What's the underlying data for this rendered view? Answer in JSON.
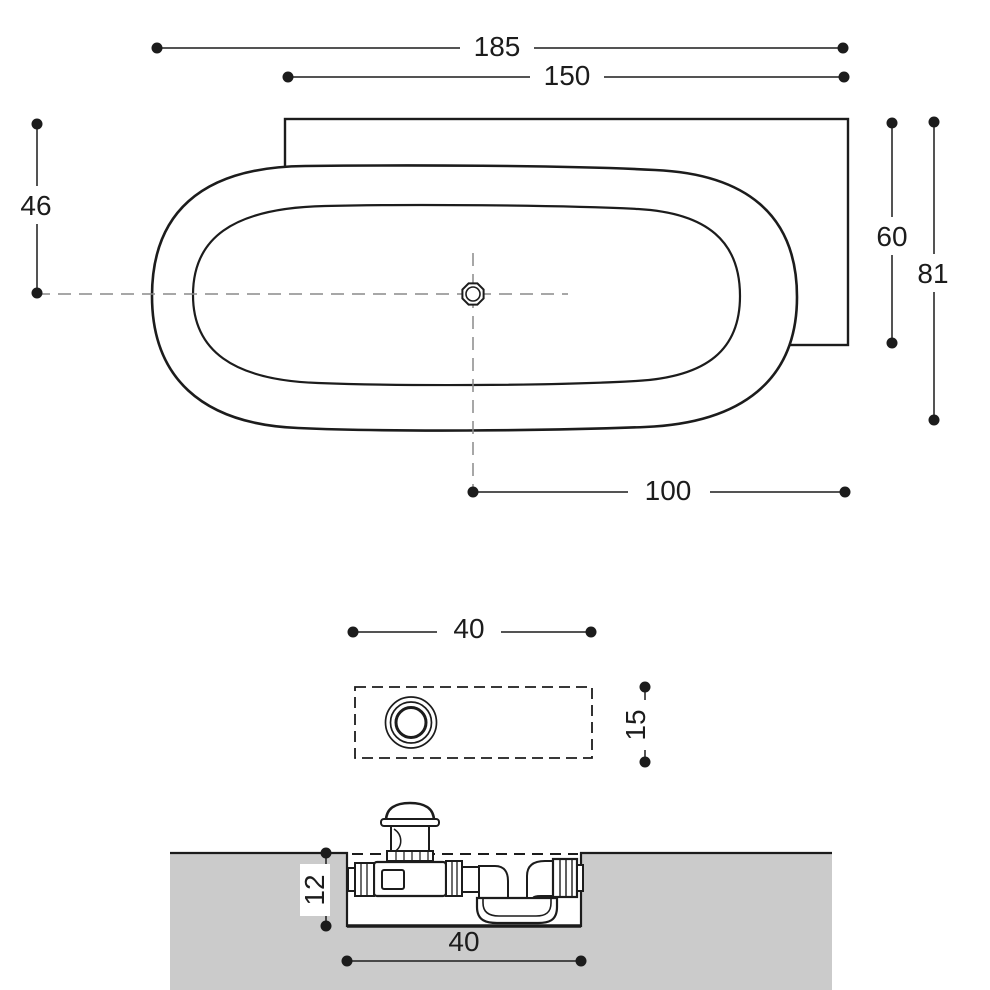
{
  "sheet": {
    "background": "#ffffff",
    "line_color": "#1c1c1c",
    "centerline_color": "#8a8a8a",
    "floor_fill": "#cbcbcb"
  },
  "plan_view": {
    "dim_overall_length": "185",
    "dim_deck_length": "150",
    "dim_center_offset": "46",
    "dim_deck_depth": "60",
    "dim_overall_depth": "81",
    "dim_drain_to_edge": "100"
  },
  "drain_recess_detail": {
    "dim_recess_length": "40",
    "dim_recess_width": "15"
  },
  "section_detail": {
    "dim_recess_depth": "12",
    "dim_recess_length": "40"
  }
}
